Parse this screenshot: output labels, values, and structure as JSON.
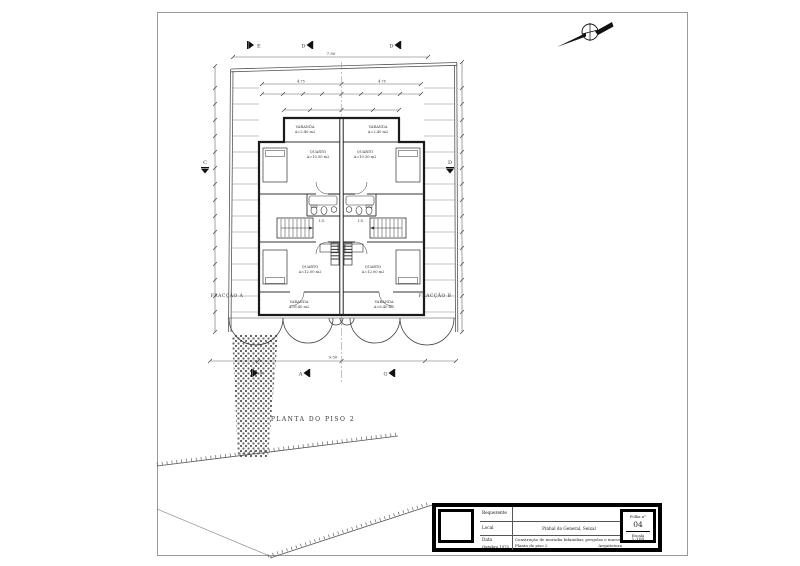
{
  "drawing": {
    "title": "PLANTA DO PISO 2",
    "fraction_a": "FRACÇÃO A",
    "fraction_b": "FRACÇÃO B"
  },
  "icons": {
    "north_arrow": "compass-north-arrow"
  },
  "section_markers": {
    "top_left": "E",
    "top_mid": "D",
    "top_right": "D",
    "left": "C",
    "right": "D",
    "bottom_left": "F",
    "bottom_mid": "A",
    "bottom_right": "G"
  },
  "dimensions": {
    "top_overall": "7.50",
    "top_left_half": "4.75",
    "top_right_half": "4.75",
    "bottom_overall": "9.50"
  },
  "rooms": {
    "varanda_top_a_name": "VARANDA",
    "varanda_top_a_area": "A=2.40 m2",
    "varanda_top_b_name": "VARANDA",
    "varanda_top_b_area": "A=2.40 m2",
    "quarto1_a_name": "QUARTO",
    "quarto1_a_area": "A=10.50 m2",
    "quarto1_b_name": "QUARTO",
    "quarto1_b_area": "A=10.50 m2",
    "is_a": "I.S.",
    "is_b": "I.S.",
    "quarto2_a_name": "QUARTO",
    "quarto2_a_area": "A=12.00 m2",
    "quarto2_b_name": "QUARTO",
    "quarto2_b_area": "A=12.00 m2",
    "varanda_a_name": "VARANDA",
    "varanda_a_area": "A=6.40 m2",
    "varanda_b_name": "VARANDA",
    "varanda_b_area": "A=6.40 m2"
  },
  "title_block": {
    "requerente": "Requerente",
    "local": "Local",
    "local_value": "Pinhal do General, Seixal",
    "data": "Data",
    "data_value": "Outubro 1975",
    "desc1": "Construção de moradia bifamiliar, pergolas e muros",
    "desc2": "Planta do piso 2",
    "arq": "Arquitetura",
    "folha": "Folha n°",
    "folha_num": "04",
    "escala": "Escala",
    "escala_val": "1:100"
  }
}
